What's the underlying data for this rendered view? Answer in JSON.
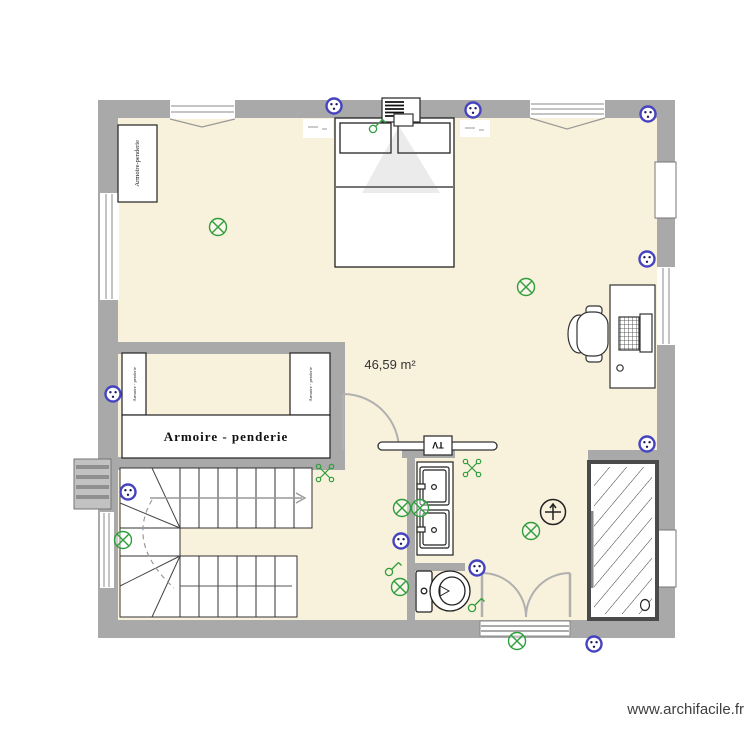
{
  "plan": {
    "area_label": "46,59 m²",
    "watermark": "www.archifacile.fr"
  },
  "labels": {
    "armoire_main": "Armoire - penderie",
    "armoire_vertical": "Armoire-penderie",
    "armoire_side_left": "Armoire - penderie",
    "armoire_side_right": "Armoire - penderie",
    "tv": "TV"
  },
  "colors": {
    "wall": "#a9a9a9",
    "floor": "#f8f1db",
    "symbol_green": "#2f9e3c",
    "outlet_blue": "#4643c0",
    "watermark_text": "#3f3f3f"
  },
  "symbols": {
    "outlet": {
      "points": [
        [
          334,
          106
        ],
        [
          473,
          110
        ],
        [
          648,
          114
        ],
        [
          647,
          259
        ],
        [
          113,
          394
        ],
        [
          128,
          492
        ],
        [
          401,
          541
        ],
        [
          477,
          568
        ],
        [
          647,
          444
        ],
        [
          594,
          644
        ]
      ]
    },
    "ceiling_light": {
      "points": [
        [
          218,
          227
        ],
        [
          526,
          287
        ],
        [
          123,
          540
        ],
        [
          402,
          508
        ],
        [
          420,
          508
        ],
        [
          400,
          587
        ],
        [
          531,
          531
        ],
        [
          517,
          641
        ]
      ]
    },
    "spot": {
      "points": [
        [
          325,
          473
        ],
        [
          472,
          468
        ]
      ]
    },
    "switch": {
      "points": [
        [
          375,
          127
        ],
        [
          391,
          570
        ],
        [
          474,
          606
        ]
      ]
    },
    "fan_vent": {
      "points": [
        [
          553,
          512
        ]
      ]
    }
  }
}
